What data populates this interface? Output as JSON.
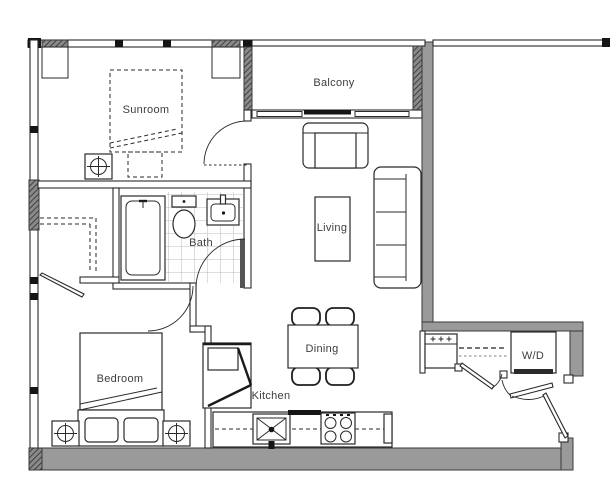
{
  "rooms": {
    "sunroom": "Sunroom",
    "balcony": "Balcony",
    "living": "Living",
    "bath": "Bath",
    "bedroom": "Bedroom",
    "dining": "Dining",
    "kitchen": "Kitchen",
    "laundry": "W/D"
  },
  "colors": {
    "background": "#ffffff",
    "wall_fill": "#9a9a9a",
    "wall_outline": "#3a3a3a",
    "line": "#2a2a2a",
    "label_text": "#3d3d3d",
    "tile_line": "#a8a8a8",
    "hatch_fill": "#6b6b6b"
  },
  "symbols": {
    "sunroom": [
      "daybed-dashed-icon",
      "side-table-dashed-icon",
      "nightstand-lamp-icon"
    ],
    "bath": [
      "bathtub-icon",
      "toilet-icon",
      "sink-icon",
      "tile-floor",
      "door-swing-arc"
    ],
    "living": [
      "armchair-icon",
      "coffee-table-icon",
      "sofa-icon"
    ],
    "dining": [
      "dining-table-icon",
      "chair-icon",
      "chair-icon",
      "chair-icon",
      "chair-icon"
    ],
    "kitchen": [
      "kitchen-sink-icon",
      "cooktop-icon",
      "counter",
      "upper-cabinet-dashed"
    ],
    "bedroom": [
      "double-bed-icon",
      "pillow-icon",
      "nightstand-lamp-icon",
      "closet-shelf-dashed",
      "door-swing-arc"
    ],
    "laundry": [
      "washer-dryer-icon",
      "appliance-icon",
      "shelf-dashed",
      "door-leaf",
      "entry-door-leaf"
    ]
  }
}
